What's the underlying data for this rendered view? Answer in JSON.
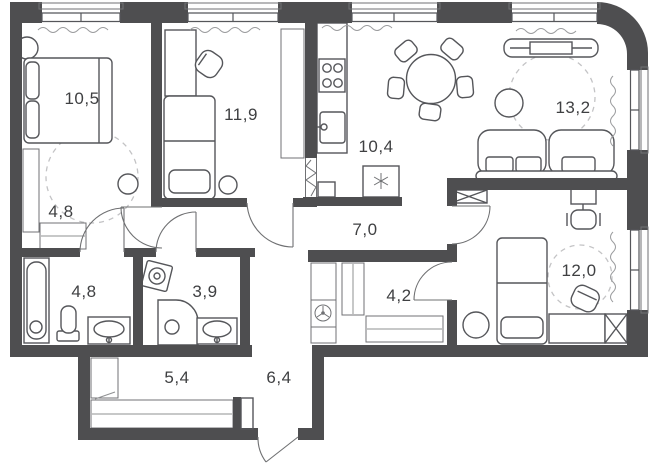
{
  "plan": {
    "type": "apartment-floor-plan",
    "rooms": [
      {
        "id": "bedroom-1",
        "area_label": "10,5"
      },
      {
        "id": "bedroom-2",
        "area_label": "11,9"
      },
      {
        "id": "kitchen",
        "area_label": "10,4"
      },
      {
        "id": "living-room",
        "area_label": "13,2"
      },
      {
        "id": "dressing",
        "area_label": "4,8"
      },
      {
        "id": "hallway",
        "area_label": "7,0"
      },
      {
        "id": "bathroom",
        "area_label": "4,8"
      },
      {
        "id": "shower-room",
        "area_label": "3,9"
      },
      {
        "id": "closet",
        "area_label": "4,2"
      },
      {
        "id": "bedroom-3",
        "area_label": "12,0"
      },
      {
        "id": "wardrobe",
        "area_label": "5,4"
      },
      {
        "id": "entry-hall",
        "area_label": "6,4"
      }
    ],
    "icons": [
      "double-bed",
      "single-bed",
      "desk",
      "desk-chair",
      "wardrobe-shelves",
      "stove",
      "kitchen-sink",
      "fridge-snowflake",
      "dining-table",
      "dining-chair",
      "tv-console",
      "sofa",
      "side-table",
      "bathtub",
      "toilet",
      "washbasin",
      "washing-machine",
      "shower",
      "ventilation-fan",
      "hanger-rod",
      "door-swing",
      "window",
      "curtain",
      "office-chair",
      "pouf",
      "clearance-circle"
    ],
    "colors": {
      "wall": "#4e4e50",
      "furniture_line": "#55565a",
      "dashed": "#c3c3c5",
      "bg": "#ffffff",
      "label": "#3f4042"
    }
  }
}
